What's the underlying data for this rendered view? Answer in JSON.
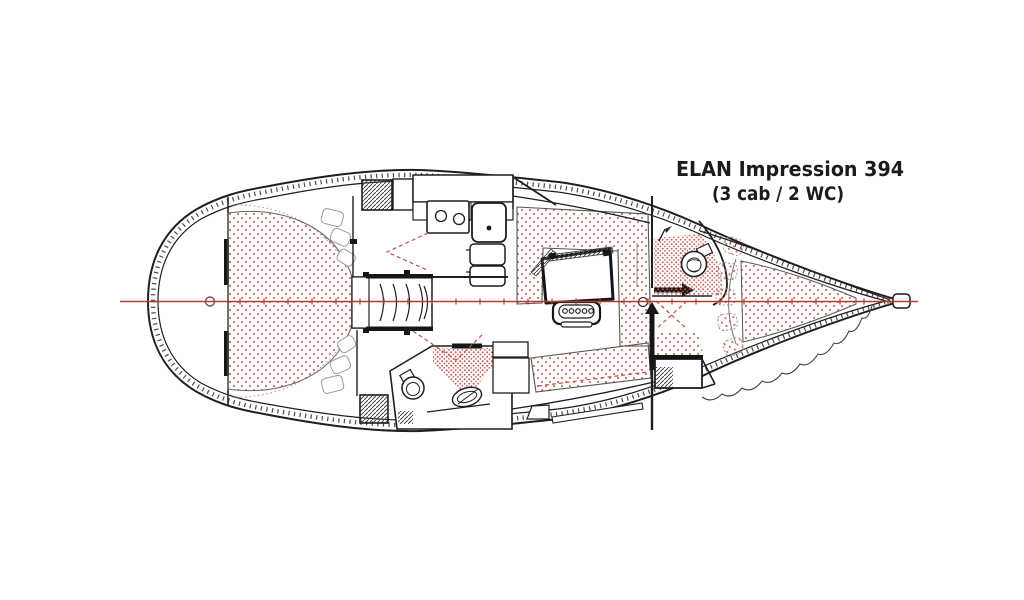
{
  "diagram": {
    "title": "ELAN Impression 394",
    "subtitle": "(3 cab / 2 WC)"
  },
  "colors": {
    "line": "#1f1f1f",
    "centerline_red": "#b23a30",
    "door_swing_red": "#c05048",
    "cushion_stipple": "#cf6f64",
    "dense_stipple": "#c4564c",
    "background": "#ffffff"
  }
}
